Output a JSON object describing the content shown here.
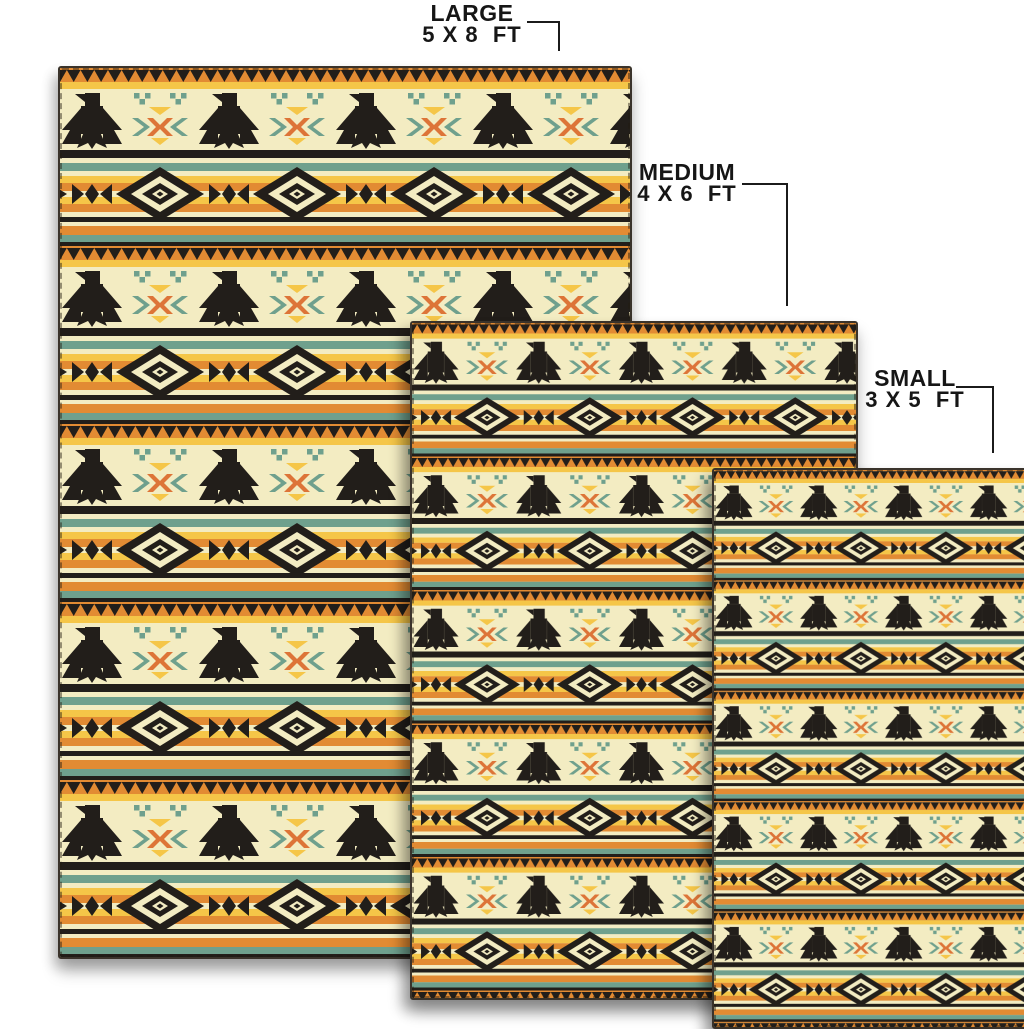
{
  "scene": {
    "background_color": "#FFFFFF",
    "description": "Rug size comparison product image with three overlapping patterned rugs"
  },
  "labels": {
    "large": {
      "name": "LARGE",
      "size": "5 X 8  FT"
    },
    "medium": {
      "name": "MEDIUM",
      "size": "4 X 6  FT"
    },
    "small": {
      "name": "SMALL",
      "size": "3 X 5  FT"
    }
  },
  "callout": {
    "line_color": "#1b1b1b",
    "text_color": "#161616"
  },
  "pattern": {
    "style": "southwestern-thunderbird-stripe",
    "motifs": [
      "thunderbird-icon",
      "stepped-diamond-medallion",
      "sawtooth-zigzag",
      "arrow-cross",
      "stripes",
      "square-cluster"
    ],
    "colors": {
      "cream": "#F3ECC2",
      "yellow": "#F5C648",
      "orange": "#E28B33",
      "rust": "#DD7438",
      "teal": "#6FA08D",
      "black": "#221E1A",
      "binding": "#3A332B"
    }
  }
}
